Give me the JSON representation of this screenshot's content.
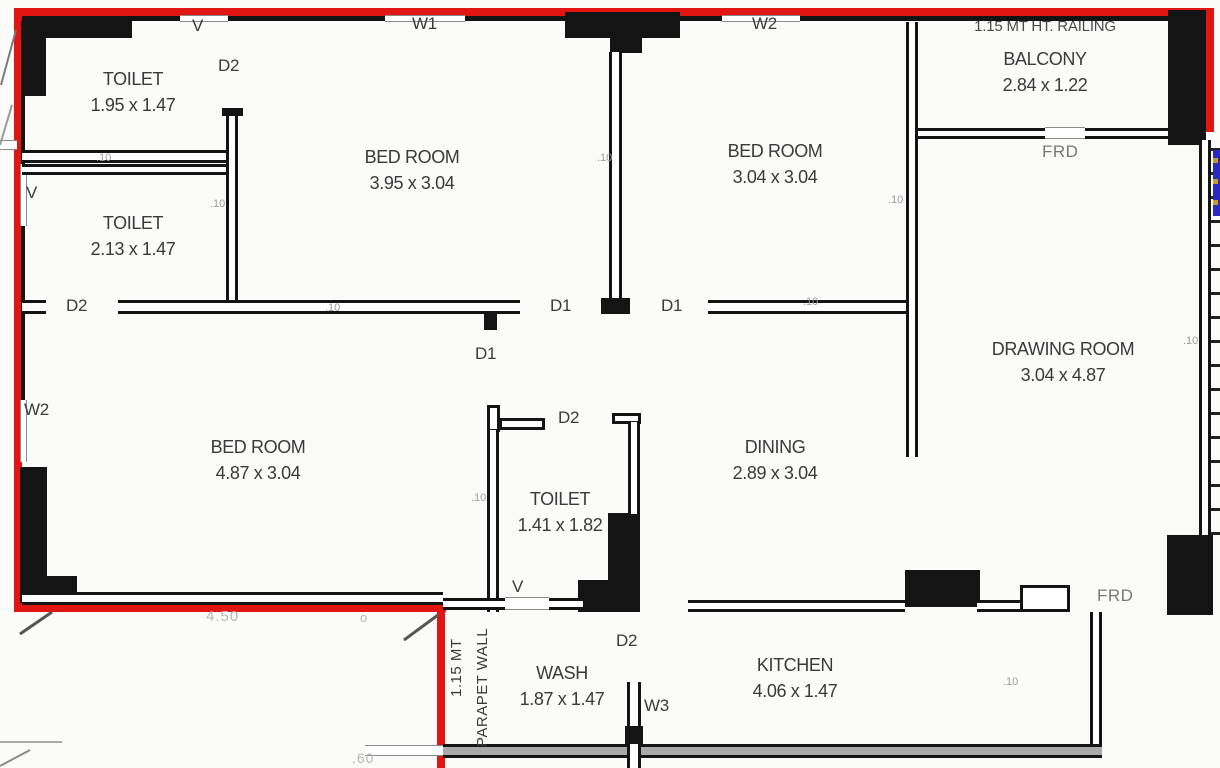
{
  "colors": {
    "boundary": "#e11511",
    "wall": "#141414",
    "text": "#3a3a3a",
    "muted": "#9c9c9c",
    "faint": "#b5b5b5",
    "wall_gray": "#a9a9a9",
    "accent_blue": "#2a2ac0",
    "accent_yellow": "#c89a30"
  },
  "plan": {
    "rooms": [
      {
        "name": "TOILET",
        "dims": "1.95 x 1.47"
      },
      {
        "name": "TOILET",
        "dims": "2.13 x 1.47"
      },
      {
        "name": "BED ROOM",
        "dims": "3.95 x 3.04"
      },
      {
        "name": "BED ROOM",
        "dims": "3.04 x 3.04"
      },
      {
        "name": "BALCONY",
        "dims": "2.84 x 1.22"
      },
      {
        "name": "DRAWING ROOM",
        "dims": "3.04 x 4.87"
      },
      {
        "name": "BED ROOM",
        "dims": "4.87 x 3.04"
      },
      {
        "name": "TOILET",
        "dims": "1.41 x 1.82"
      },
      {
        "name": "DINING",
        "dims": "2.89 x 3.04"
      },
      {
        "name": "WASH",
        "dims": "1.87 x 1.47"
      },
      {
        "name": "KITCHEN",
        "dims": "4.06 x 1.47"
      }
    ],
    "balcony_railing_note": "1.15 MT HT. RAILING",
    "markers": {
      "v_top": "V",
      "d2_toilet_top": "D2",
      "w1_top": "W1",
      "w2_top": "W2",
      "v_left": "V",
      "d2_left": "D2",
      "w2_left": "W2",
      "d1_bedroom1": "D1",
      "d1_bedroom2": "D1",
      "d1_hall": "D1",
      "d2_toilet_mid": "D2",
      "v_toilet_mid": "V",
      "d2_kitchen": "D2",
      "w3_wash": "W3",
      "frd_balcony": "FRD",
      "frd_entry": "FRD"
    },
    "wall_thickness_label": ".10",
    "dimensions": {
      "bottom_width": "4.50",
      "circle_mark": "o",
      "offset": ".60"
    },
    "parapet": {
      "line1": "1.15 MT",
      "line2": "PARAPET WALL"
    }
  }
}
